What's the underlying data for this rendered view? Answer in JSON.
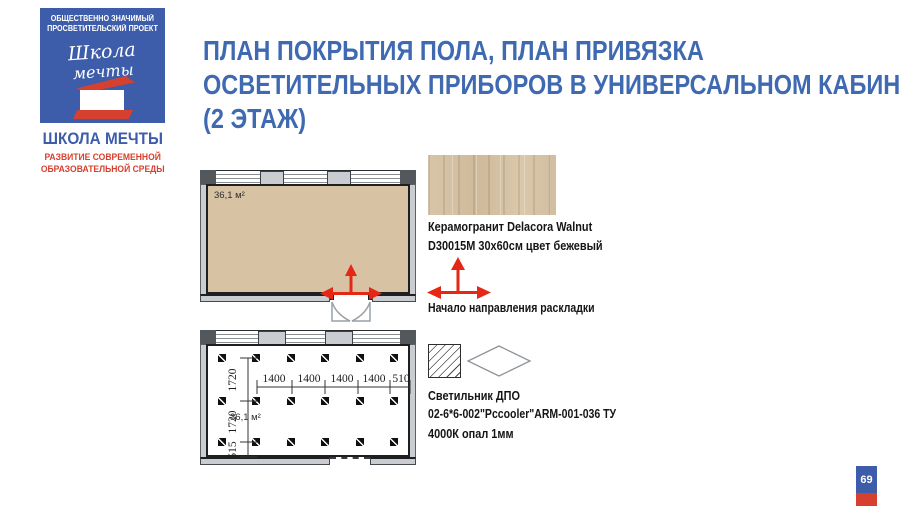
{
  "colors": {
    "blue": "#3d5caa",
    "red2": "#d6402e",
    "title-blue": "#3f6ab1",
    "arrow-red": "#e52716",
    "wall-gray": "#c9cdd1",
    "wall-dark": "#53585d",
    "wood-base": "#d7c3a4"
  },
  "logo": {
    "top_line1": "ОБЩЕСТВЕННО ЗНАЧИМЫЙ",
    "top_line2": "ПРОСВЕТИТЕЛЬСКИЙ ПРОЕКТ",
    "script_line1": "Школа",
    "script_line2": "мечты",
    "name": "ШКОЛА МЕЧТЫ",
    "subtitle_line1": "РАЗВИТИЕ СОВРЕМЕННОЙ",
    "subtitle_line2": "ОБРАЗОВАТЕЛЬНОЙ СРЕДЫ"
  },
  "title": {
    "lines": [
      "ПЛАН ПОКРЫТИЯ ПОЛА, ПЛАН ПРИВЯЗКА",
      "ОСВЕТИТЕЛЬНЫХ ПРИБОРОВ В УНИВЕРСАЛЬНОМ КАБИНЕТЕ",
      "(2 ЭТАЖ)"
    ]
  },
  "floor_plan": {
    "area_label": "36,1 м²"
  },
  "lighting_plan": {
    "area_label": "36,1 м²",
    "h_dims": [
      "1400",
      "1400",
      "1400",
      "1400",
      "510"
    ],
    "v_dims": [
      "1720",
      "1720",
      "515"
    ],
    "fixture_rows": 3,
    "fixture_cols": 6
  },
  "legend_floor": {
    "material_line1": "Керамогранит Delacora Walnut",
    "material_line2": "D30015M 30x60см цвет бежевый",
    "direction_label": "Начало направления раскладки"
  },
  "legend_light": {
    "line1": "Светильник ДПО",
    "line2": "02-6*6-002\"Pccooler\"ARM-001-036 ТУ",
    "line3": "4000К опал 1мм"
  },
  "page": {
    "page_number": "69"
  }
}
